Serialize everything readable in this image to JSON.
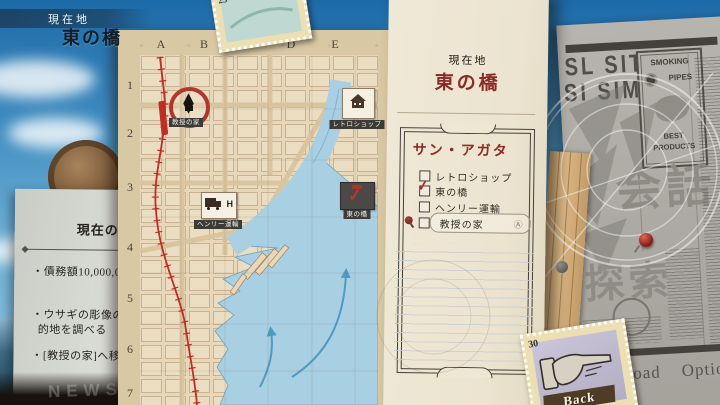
{
  "hud": {
    "location_label": "現在地",
    "location_name": "東の橋"
  },
  "goals": {
    "heading": "現在の",
    "lines": [
      "・債務額10,000,000",
      "・ウサギの彫像の配",
      "的地を調べる",
      "・[教授の家]へ移動"
    ]
  },
  "map": {
    "stamp_value": "25",
    "grid_cols": [
      "A",
      "B",
      "C",
      "D",
      "E"
    ],
    "grid_rows": [
      "1",
      "2",
      "3",
      "4",
      "5",
      "6",
      "7"
    ],
    "markers": [
      {
        "name": "教授の家"
      },
      {
        "name": "レトロショップ"
      },
      {
        "name": "ヘンリー運輸"
      },
      {
        "name": "東の橋"
      }
    ],
    "truck_letter": "H"
  },
  "journal": {
    "location_label": "現在地",
    "location_name": "東の橋",
    "list_title": "サン・アガタ",
    "items": [
      {
        "label": "レトロショップ",
        "checked": false
      },
      {
        "label": "東の橋",
        "checked": true,
        "check_glyph": "✓"
      },
      {
        "label": "ヘンリー運輸",
        "checked": false
      },
      {
        "label": "教授の家",
        "checked": false,
        "selected": true,
        "button_hint": "Ⓐ"
      }
    ]
  },
  "newspaper": {
    "headline_1": "SL SIT",
    "headline_2": "SI SIM",
    "ad_line_1": "SMOKING",
    "ad_line_2": "PIPES",
    "ad_line_3": "BEST",
    "ad_line_4": "PRODUCTS",
    "kanji_conversation": "会話",
    "kanji_explore": "探索",
    "masthead": "NEWS"
  },
  "menu": {
    "back_label": "Back",
    "back_stamp_value": "30",
    "load_label": "Load",
    "options_label": "Options"
  },
  "colors": {
    "accent_red": "#b0372e",
    "journal_red": "#8b2b26",
    "water_blue": "#a9cfe2",
    "railway_red": "#bf2e26"
  }
}
